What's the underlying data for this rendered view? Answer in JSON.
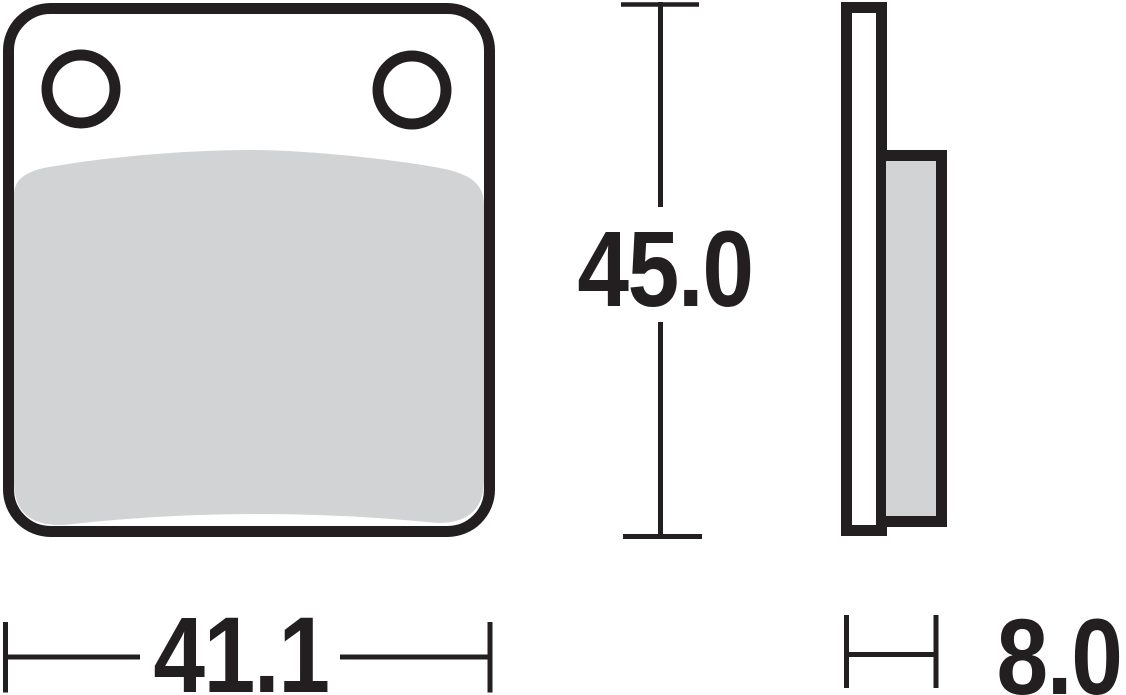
{
  "drawing": {
    "type": "technical-drawing",
    "subject": "brake pad, front and side views",
    "colors": {
      "line": "#231f20",
      "pad_fill": "#d2d3d4",
      "plate_fill": "#ffffff",
      "background": "#ffffff"
    },
    "dimensions": {
      "height": {
        "value": "45.0"
      },
      "width": {
        "value": "41.1"
      },
      "thickness": {
        "value": "8.0"
      }
    }
  }
}
